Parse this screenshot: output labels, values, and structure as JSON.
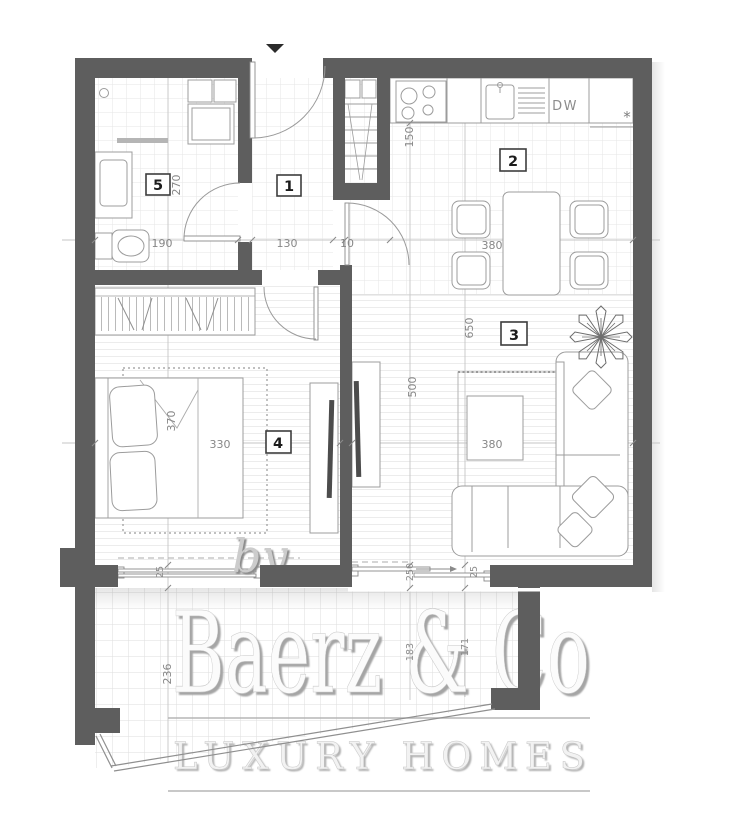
{
  "plan": {
    "room_numbers": {
      "hallway": "1",
      "kitchen_dining": "2",
      "living_room": "3",
      "bedroom": "4",
      "bathroom": "5"
    },
    "dimensions": {
      "bathroom_depth": "270",
      "bathroom_width": "190",
      "hallway_width": "130",
      "wall_thickness": "10",
      "kitchen_counter_depth": "150",
      "dining_width": "380",
      "living_length": "650",
      "partition_length": "500",
      "living_width": "380",
      "bed_length": "370",
      "bed_width": "330",
      "terrace_height": "236",
      "terrace_depth_left": "183",
      "terrace_depth_right": "171",
      "bedroom_window": "25",
      "terrace_door_width": "250",
      "terrace_door_gap": "25"
    },
    "labels": {
      "dishwasher": "DW",
      "counter_asterisk": "*"
    }
  },
  "watermark": {
    "prefix": "by",
    "brand": "Baerz & Co",
    "tagline": "LUXURY HOMES"
  }
}
